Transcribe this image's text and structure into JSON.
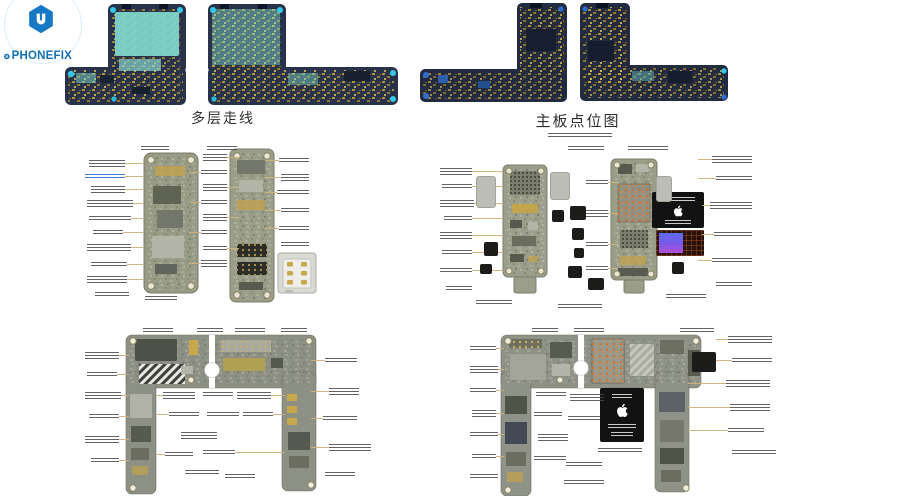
{
  "brand": {
    "name": "PHONEFIX",
    "icons": [
      "hex-wrench-icon",
      "circle-x-icon"
    ]
  },
  "figures": {
    "multilayer": {
      "caption": "多层走线"
    },
    "pointmap": {
      "caption": "主板点位图"
    }
  },
  "diagrams": {
    "front_halves": {
      "description_visible_text": "",
      "sim_connector_present": true
    },
    "back_halves": {
      "apple_chip_present": true,
      "gradient_chip_present": true
    },
    "unfolded_front": {
      "hatched_region_present": true
    },
    "unfolded_back": {
      "apple_chip_present": true
    }
  },
  "colors": {
    "brand_blue": "#1371b4",
    "pcb_navy": "#28324a",
    "pcb_teal": "#7fd9ce",
    "pcb_gold": "#c2a43c",
    "board_gray_green": "#989b86",
    "annotation_leader": "#cdb27a",
    "chip_black": "#1c1d1b",
    "hole_cyan": "#35c8e8",
    "hole_blue": "#2e6ed2"
  }
}
